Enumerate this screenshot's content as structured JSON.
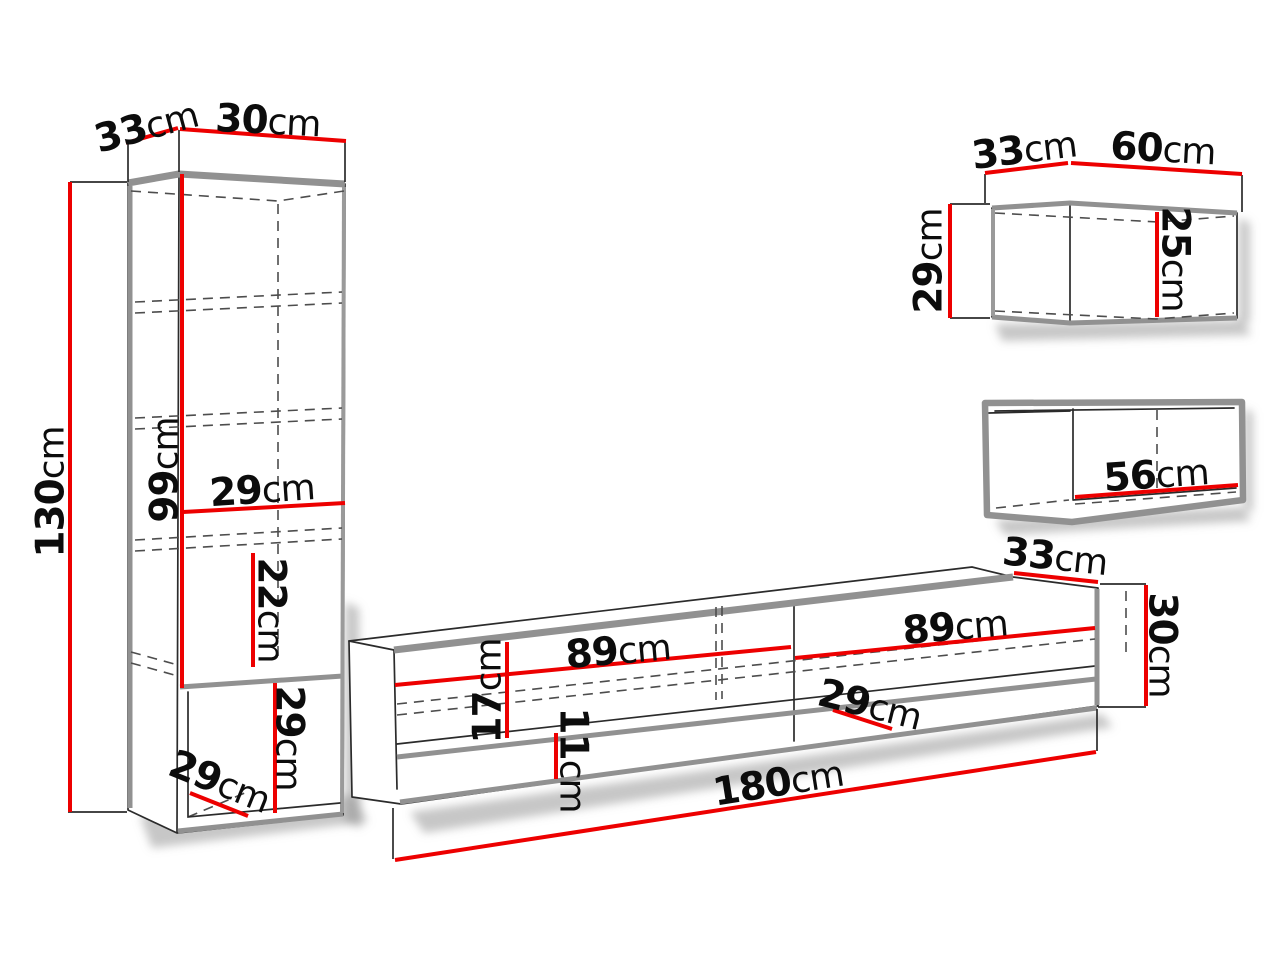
{
  "diagram_kind": "furniture-dimension-drawing",
  "unit": "cm",
  "colors": {
    "dimension_line_red": "#ed0000",
    "edge_gray": "#919191",
    "outline_black": "#2b2b2b",
    "background": "#ffffff"
  },
  "pieces": {
    "tall_cabinet": {
      "label": "tall-cabinet",
      "dims": {
        "depth_top": {
          "value": "33",
          "unit": "cm"
        },
        "width_top": {
          "value": "30",
          "unit": "cm"
        },
        "height_total": {
          "value": "130",
          "unit": "cm"
        },
        "height_upper": {
          "value": "99",
          "unit": "cm"
        },
        "inner_width": {
          "value": "29",
          "unit": "cm"
        },
        "shelf_spacing": {
          "value": "22",
          "unit": "cm"
        },
        "niche_height": {
          "value": "29",
          "unit": "cm"
        },
        "niche_depth": {
          "value": "29",
          "unit": "cm"
        }
      }
    },
    "tv_stand": {
      "label": "tv-stand",
      "dims": {
        "section_left_width": {
          "value": "89",
          "unit": "cm"
        },
        "flap_height": {
          "value": "17",
          "unit": "cm"
        },
        "niche_height": {
          "value": "11",
          "unit": "cm"
        },
        "niche_depth": {
          "value": "29",
          "unit": "cm"
        },
        "section_right_width": {
          "value": "89",
          "unit": "cm"
        },
        "depth_top": {
          "value": "33",
          "unit": "cm"
        },
        "height": {
          "value": "30",
          "unit": "cm"
        },
        "total_width": {
          "value": "180",
          "unit": "cm"
        }
      }
    },
    "wall_cabinet_large": {
      "label": "wall-cabinet-large",
      "dims": {
        "depth_top": {
          "value": "33",
          "unit": "cm"
        },
        "width": {
          "value": "60",
          "unit": "cm"
        },
        "height": {
          "value": "29",
          "unit": "cm"
        },
        "inner_height": {
          "value": "25",
          "unit": "cm"
        }
      }
    },
    "wall_cabinet_small": {
      "label": "wall-cabinet-small",
      "dims": {
        "inner_width": {
          "value": "56",
          "unit": "cm"
        }
      }
    }
  }
}
